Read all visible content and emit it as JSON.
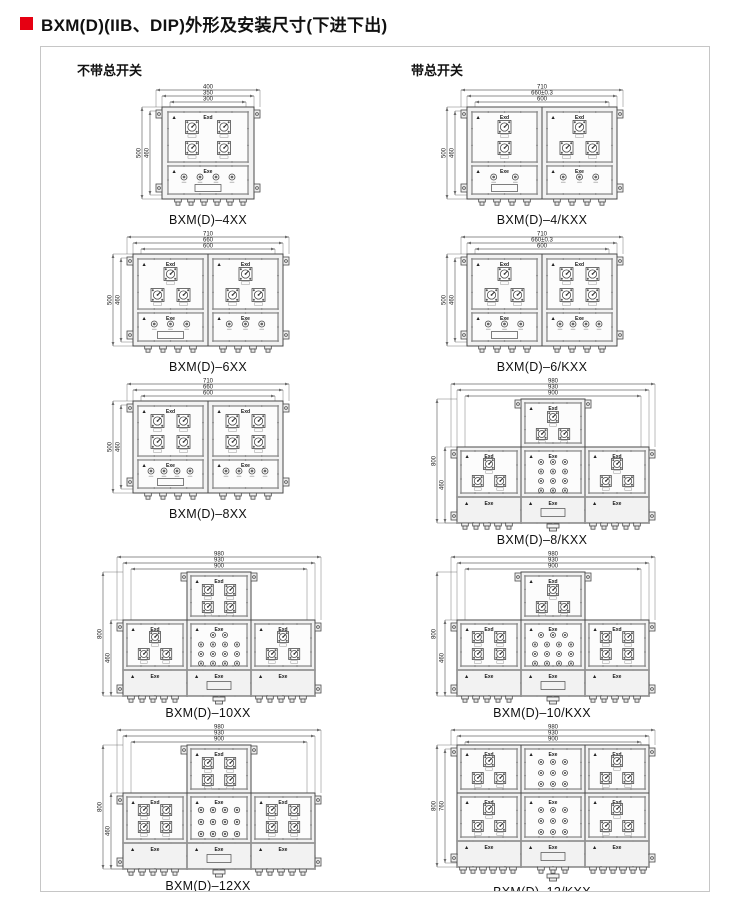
{
  "page": {
    "title": "BXM(D)(IIB、DIP)外形及安装尺寸(下进下出)",
    "accent_color": "#e60012",
    "columns": [
      {
        "header": "不带总开关"
      },
      {
        "header": "带总开关"
      }
    ]
  },
  "labels": {
    "exd": "Exd",
    "exe": "Exe"
  },
  "drawings": [
    {
      "id": "4xx",
      "model": "BXM(D)–4XX",
      "layout": "single",
      "dims_top": [
        "400",
        "350",
        "300"
      ],
      "dims_left": [
        "500",
        "460"
      ],
      "breakers": [
        [
          0.3,
          0.7
        ],
        [
          0.3,
          0.7
        ]
      ],
      "buttons": 4
    },
    {
      "id": "4kxx",
      "model": "BXM(D)–4/KXX",
      "layout": "double",
      "dims_top": [
        "710",
        "660±0.3",
        "600"
      ],
      "dims_left": [
        "500",
        "460"
      ],
      "panels": [
        {
          "rows": [
            [
              0.5
            ],
            [
              0.5
            ]
          ],
          "buttons": 2
        },
        {
          "rows": [
            [
              0.5
            ],
            [
              0.3,
              0.7
            ]
          ],
          "buttons": 3
        }
      ]
    },
    {
      "id": "6xx",
      "model": "BXM(D)–6XX",
      "layout": "double",
      "dims_top": [
        "710",
        "660",
        "600"
      ],
      "dims_left": [
        "500",
        "460"
      ],
      "panels": [
        {
          "rows": [
            [
              0.5
            ],
            [
              0.3,
              0.7
            ]
          ],
          "buttons": 3
        },
        {
          "rows": [
            [
              0.5
            ],
            [
              0.3,
              0.7
            ]
          ],
          "buttons": 3
        }
      ]
    },
    {
      "id": "6kxx",
      "model": "BXM(D)–6/KXX",
      "layout": "double",
      "dims_top": [
        "710",
        "660±0.3",
        "600"
      ],
      "dims_left": [
        "500",
        "460"
      ],
      "panels": [
        {
          "rows": [
            [
              0.5
            ],
            [
              0.3,
              0.7
            ]
          ],
          "buttons": 3
        },
        {
          "rows": [
            [
              0.3,
              0.7
            ],
            [
              0.3,
              0.7
            ]
          ],
          "buttons": 4
        }
      ]
    },
    {
      "id": "8xx",
      "model": "BXM(D)–8XX",
      "layout": "double",
      "dims_top": [
        "710",
        "660",
        "600"
      ],
      "dims_left": [
        "500",
        "460"
      ],
      "panels": [
        {
          "rows": [
            [
              0.3,
              0.7
            ],
            [
              0.3,
              0.7
            ]
          ],
          "buttons": 4
        },
        {
          "rows": [
            [
              0.3,
              0.7
            ],
            [
              0.3,
              0.7
            ]
          ],
          "buttons": 4
        }
      ]
    },
    {
      "id": "8kxx",
      "model": "BXM(D)–8/KXX",
      "layout": "tee",
      "dims_top": [
        "980",
        "930",
        "900"
      ],
      "dims_left": [
        "800",
        "460"
      ],
      "top": [
        [
          0.5
        ],
        [
          0.3,
          0.7
        ]
      ],
      "left": [
        [
          0.5
        ],
        [
          0.3,
          0.7
        ]
      ],
      "right": [
        [
          0.5
        ],
        [
          0.3,
          0.7
        ]
      ],
      "mid": [
        3,
        3,
        3,
        3
      ]
    },
    {
      "id": "10xx",
      "model": "BXM(D)–10XX",
      "layout": "tee",
      "dims_top": [
        "980",
        "930",
        "900"
      ],
      "dims_left": [
        "800",
        "460"
      ],
      "top": [
        [
          0.3,
          0.7
        ],
        [
          0.3,
          0.7
        ]
      ],
      "left": [
        [
          0.5
        ],
        [
          0.3,
          0.7
        ]
      ],
      "right": [
        [
          0.5
        ],
        [
          0.3,
          0.7
        ]
      ],
      "mid": [
        2,
        4,
        4,
        4
      ]
    },
    {
      "id": "10kxx",
      "model": "BXM(D)–10/KXX",
      "layout": "tee",
      "dims_top": [
        "980",
        "930",
        "900"
      ],
      "dims_left": [
        "800",
        "460"
      ],
      "top": [
        [
          0.5
        ],
        [
          0.3,
          0.7
        ]
      ],
      "left": [
        [
          0.3,
          0.7
        ],
        [
          0.3,
          0.7
        ]
      ],
      "right": [
        [
          0.3,
          0.7
        ],
        [
          0.3,
          0.7
        ]
      ],
      "mid": [
        3,
        4,
        4,
        4
      ]
    },
    {
      "id": "12xx",
      "model": "BXM(D)–12XX",
      "layout": "tee",
      "dims_top": [
        "980",
        "930",
        "900"
      ],
      "dims_left": [
        "800",
        "460"
      ],
      "top": [
        [
          0.3,
          0.7
        ],
        [
          0.3,
          0.7
        ]
      ],
      "left": [
        [
          0.3,
          0.7
        ],
        [
          0.3,
          0.7
        ]
      ],
      "right": [
        [
          0.3,
          0.7
        ],
        [
          0.3,
          0.7
        ]
      ],
      "mid": [
        4,
        4,
        4
      ]
    },
    {
      "id": "12kxx",
      "model": "BXM(D)–12/KXX",
      "layout": "grid",
      "dims_top": [
        "980",
        "930",
        "900"
      ],
      "dims_left": [
        "800",
        "760"
      ],
      "rows": [
        {
          "left": [
            [
              0.5
            ],
            [
              0.3,
              0.7
            ]
          ],
          "mid": [
            3,
            3,
            3
          ],
          "right": [
            [
              0.5
            ],
            [
              0.3,
              0.7
            ]
          ]
        },
        {
          "left": [
            [
              0.5
            ],
            [
              0.3,
              0.7
            ]
          ],
          "mid": [
            3,
            3,
            3
          ],
          "right": [
            [
              0.5
            ],
            [
              0.3,
              0.7
            ]
          ]
        }
      ]
    }
  ]
}
